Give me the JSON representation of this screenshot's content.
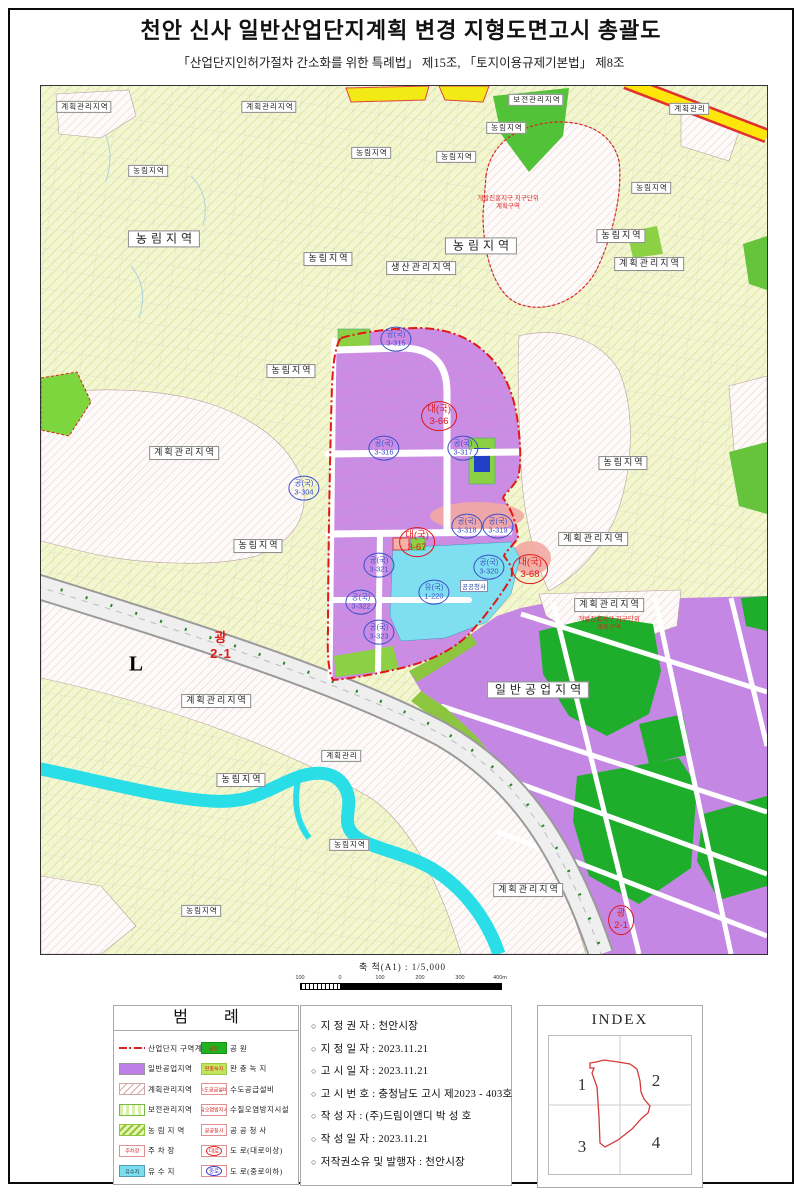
{
  "doc": {
    "title": "천안 신사 일반산업단지계획 변경 지형도면고시 총괄도",
    "subtitle": "「산업단지인허가절차 간소화를 위한 특례법」 제15조, 「토지이용규제기본법」 제8조"
  },
  "scalebar": {
    "label": "축  척(A1) : 1/5,000",
    "ticks": [
      "100",
      "0",
      "100",
      "200",
      "300",
      "400m"
    ]
  },
  "map": {
    "colors": {
      "industrial_purple": "#c487e4",
      "farmland": "#f4f6d2",
      "park_green": "#1fae2c",
      "buffer_green": "#8cd044",
      "river_cyan": "#2adee8",
      "boundary_red": "#e01818",
      "highway_yellow": "#ffe60a",
      "reservoir_cyan": "#7fdef0",
      "parcel_blue_text": "#3a50c8"
    },
    "zone_labels": [
      {
        "t": "계획관리지역",
        "x": 43,
        "y": 21,
        "s": 1
      },
      {
        "t": "계획관리지역",
        "x": 228,
        "y": 21,
        "s": 1
      },
      {
        "t": "보전관리지역",
        "x": 495,
        "y": 14,
        "s": 1
      },
      {
        "t": "계획관리",
        "x": 648,
        "y": 23,
        "s": 1
      },
      {
        "t": "농림지역",
        "x": 330,
        "y": 67,
        "s": 1
      },
      {
        "t": "농림지역",
        "x": 465,
        "y": 42,
        "s": 1
      },
      {
        "t": "농림지역",
        "x": 107,
        "y": 85,
        "s": 1
      },
      {
        "t": "농림지역",
        "x": 415,
        "y": 71,
        "s": 1
      },
      {
        "t": "농림지역",
        "x": 610,
        "y": 102,
        "s": 1
      },
      {
        "t": "농림지역",
        "x": 123,
        "y": 153,
        "s": 3
      },
      {
        "t": "농림지역",
        "x": 287,
        "y": 173,
        "s": 2
      },
      {
        "t": "농림지역",
        "x": 440,
        "y": 160,
        "s": 3
      },
      {
        "t": "농림지역",
        "x": 580,
        "y": 150,
        "s": 2
      },
      {
        "t": "생산관리지역",
        "x": 380,
        "y": 182,
        "s": 2
      },
      {
        "t": "계획관리지역",
        "x": 608,
        "y": 178,
        "s": 2
      },
      {
        "t": "농림지역",
        "x": 250,
        "y": 285,
        "s": 2
      },
      {
        "t": "계획관리지역",
        "x": 143,
        "y": 367,
        "s": 2
      },
      {
        "t": "농림지역",
        "x": 217,
        "y": 460,
        "s": 2
      },
      {
        "t": "계획관리지역",
        "x": 552,
        "y": 453,
        "s": 2
      },
      {
        "t": "농림지역",
        "x": 582,
        "y": 377,
        "s": 2
      },
      {
        "t": "계획관리지역",
        "x": 175,
        "y": 615,
        "s": 2
      },
      {
        "t": "계획관리",
        "x": 300,
        "y": 670,
        "s": 1
      },
      {
        "t": "농림지역",
        "x": 200,
        "y": 694,
        "s": 2
      },
      {
        "t": "농림지역",
        "x": 308,
        "y": 759,
        "s": 1
      },
      {
        "t": "농림지역",
        "x": 160,
        "y": 825,
        "s": 1
      },
      {
        "t": "계획관리지역",
        "x": 568,
        "y": 519,
        "s": 2
      },
      {
        "t": "일반공업지역",
        "x": 497,
        "y": 604,
        "s": 3
      },
      {
        "t": "계획관리지역",
        "x": 487,
        "y": 804,
        "s": 2
      }
    ],
    "parcel_labels": [
      {
        "a": "공(국)",
        "b": "3-315",
        "c": "b",
        "x": 355,
        "y": 253
      },
      {
        "a": "대(국)",
        "b": "3-66",
        "c": "r",
        "x": 398,
        "y": 330
      },
      {
        "a": "공(국)",
        "b": "3-316",
        "c": "b",
        "x": 343,
        "y": 362
      },
      {
        "a": "공(국)",
        "b": "3-317",
        "c": "b",
        "x": 422,
        "y": 362
      },
      {
        "a": "공(국)",
        "b": "3-304",
        "c": "b",
        "x": 263,
        "y": 402
      },
      {
        "a": "공(국)",
        "b": "3-318",
        "c": "b",
        "x": 426,
        "y": 440
      },
      {
        "a": "공(국)",
        "b": "3-319",
        "c": "b",
        "x": 457,
        "y": 440
      },
      {
        "a": "대(국)",
        "b": "3-67",
        "c": "r",
        "x": 376,
        "y": 456
      },
      {
        "a": "공(국)",
        "b": "3-320",
        "c": "b",
        "x": 448,
        "y": 481
      },
      {
        "a": "대(국)",
        "b": "3-68",
        "c": "r",
        "x": 489,
        "y": 483
      },
      {
        "a": "유(국)",
        "b": "1-220",
        "c": "b",
        "x": 393,
        "y": 506
      },
      {
        "a": "공(국)",
        "b": "3-321",
        "c": "b",
        "x": 338,
        "y": 479
      },
      {
        "a": "공(국)",
        "b": "3-322",
        "c": "b",
        "x": 320,
        "y": 516
      },
      {
        "a": "공(국)",
        "b": "3-323",
        "c": "b",
        "x": 338,
        "y": 546
      },
      {
        "a": "광",
        "b": "2-1",
        "c": "r",
        "x": 180,
        "y": 560,
        "big": true
      },
      {
        "a": "광",
        "b": "2-1",
        "c": "r",
        "x": 580,
        "y": 834
      }
    ],
    "free_labels": [
      {
        "t": "L",
        "x": 95,
        "y": 578,
        "cls": "lmark"
      },
      {
        "t": "공공청사",
        "x": 433,
        "y": 500,
        "cls": "tinybox"
      },
      {
        "t": "개발진흥지구 지구단위계획구역",
        "x": 467,
        "y": 117,
        "cls": "ann"
      },
      {
        "t": "개발진흥지구 지구단위계획구역",
        "x": 568,
        "y": 538,
        "cls": "ann"
      }
    ]
  },
  "legend": {
    "title": "범    례",
    "left": [
      {
        "label": "산업단지 구역계",
        "type": "boundary"
      },
      {
        "label": "일반공업지역",
        "type": "purple"
      },
      {
        "label": "계획관리지역",
        "type": "hatchpink"
      },
      {
        "label": "보전관리지역",
        "type": "dotsgreen"
      },
      {
        "label": "농 림 지 역",
        "type": "hatchgreen"
      },
      {
        "label": "주 차 장",
        "type": "symbox",
        "sym": "주차장"
      },
      {
        "label": "유 수 지",
        "type": "cyan",
        "sym": "유수지"
      }
    ],
    "right": [
      {
        "label": "공  원",
        "type": "green",
        "sym": "공원"
      },
      {
        "label": "완 충 녹 지",
        "type": "ygreen",
        "sym": "완충녹지"
      },
      {
        "label": "수도공급설비",
        "type": "symbox",
        "sym": "수도공급설비"
      },
      {
        "label": "수질오염방지시설",
        "type": "symbox",
        "sym": "수질오염방지시설"
      },
      {
        "label": "공 공 청 사",
        "type": "symbox",
        "sym": "공공청사"
      },
      {
        "label": "도  로(대로이상)",
        "type": "roadred",
        "sym": "대로"
      },
      {
        "label": "도  로(중로이하)",
        "type": "roadblue",
        "sym": "중로"
      }
    ]
  },
  "info": {
    "bullet": "○",
    "items": [
      "지 정 권 자 : 천안시장",
      "지 정 일 자 : 2023.11.21",
      "고 시 일 자 : 2023.11.21",
      "고 시 번 호 : 충청남도 고시 제2023 - 403호",
      "작   성   자 : (주)드림이앤디 박 성 호",
      "작 성 일 자 : 2023.11.21",
      "저작권소유 및 발행자 : 천안시장"
    ]
  },
  "index": {
    "title": "INDEX",
    "cells": [
      "1",
      "2",
      "3",
      "4"
    ]
  }
}
